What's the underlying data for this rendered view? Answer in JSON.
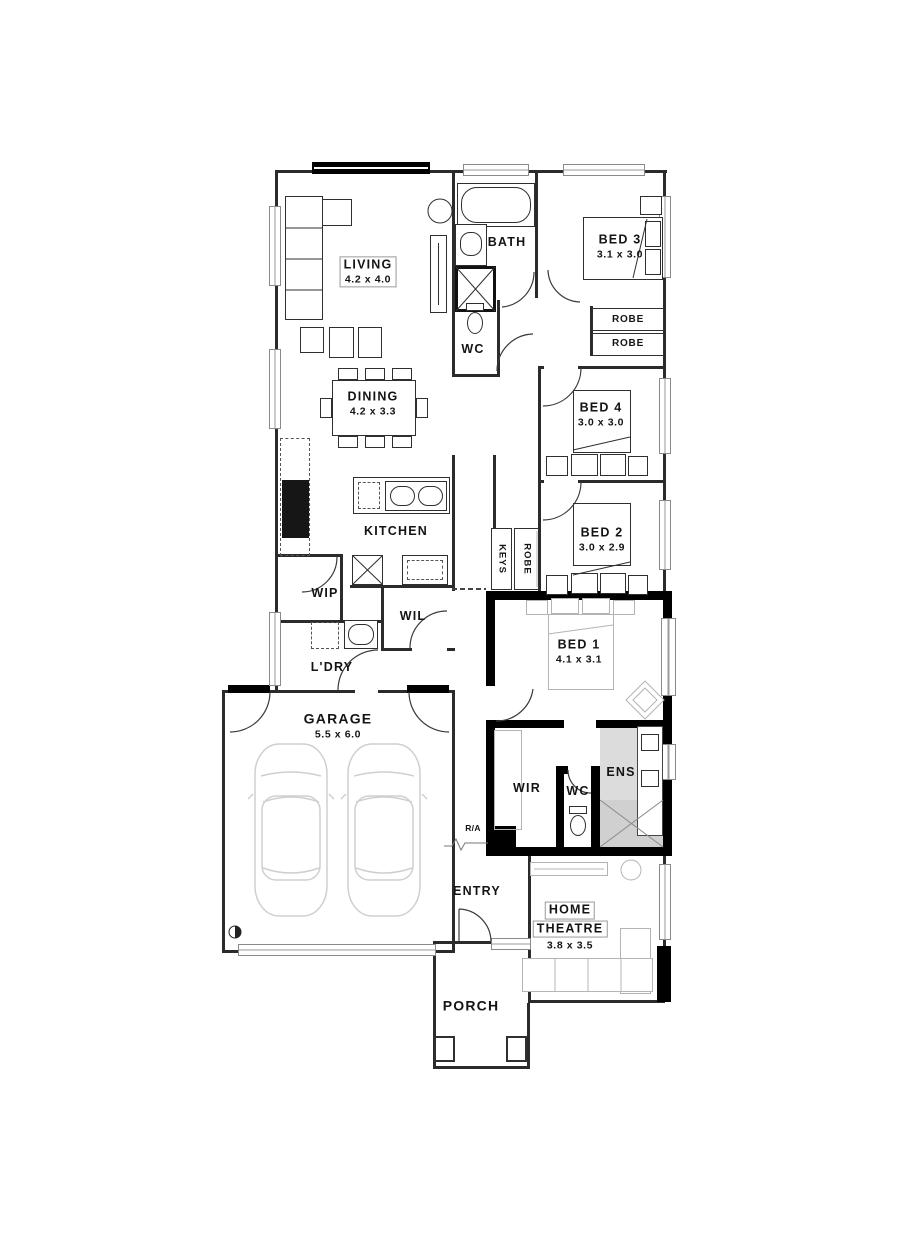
{
  "rooms": {
    "living": {
      "name": "LIVING",
      "dims": "4.2 x 4.0"
    },
    "dining": {
      "name": "DINING",
      "dims": "4.2 x 3.3"
    },
    "kitchen": {
      "name": "KITCHEN"
    },
    "bath": {
      "name": "BATH"
    },
    "wc": {
      "name": "WC"
    },
    "bed3": {
      "name": "BED 3",
      "dims": "3.1 x 3.0"
    },
    "bed4": {
      "name": "BED 4",
      "dims": "3.0 x 3.0"
    },
    "bed2": {
      "name": "BED 2",
      "dims": "3.0 x 2.9"
    },
    "bed1": {
      "name": "BED 1",
      "dims": "4.1 x 3.1"
    },
    "wip": {
      "name": "WIP"
    },
    "wil": {
      "name": "WIL"
    },
    "ldry": {
      "name": "L'DRY"
    },
    "garage": {
      "name": "GARAGE",
      "dims": "5.5 x 6.0"
    },
    "wir": {
      "name": "WIR"
    },
    "ens": {
      "name": "ENS"
    },
    "ens_wc": {
      "name": "WC"
    },
    "entry": {
      "name": "ENTRY"
    },
    "home_theatre": {
      "line1": "HOME",
      "line2": "THEATRE",
      "dims": "3.8 x 3.5"
    },
    "porch": {
      "name": "PORCH"
    }
  },
  "storage": {
    "robe_bed3_a": "ROBE",
    "robe_bed3_b": "ROBE",
    "keys": "KEYS",
    "robe_bed2": "ROBE"
  },
  "annotations": {
    "return_air": "R/A"
  },
  "colors": {
    "wall": "#2b2b2b",
    "thick_wall": "#000000",
    "furniture_dark": "#2f2f2f",
    "furniture_light": "#b4b4b4",
    "car_outline": "#cfcfcf",
    "ensuite_shade": "#dcdcdc",
    "shower_shade": "#d0d0d0",
    "text": "#141414"
  }
}
